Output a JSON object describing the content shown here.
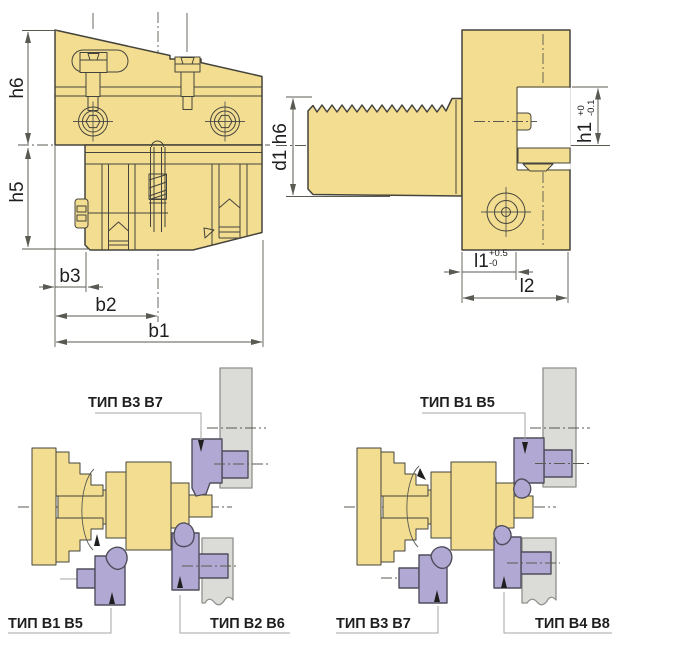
{
  "colors": {
    "background": "#FFFFFF",
    "part_fill": "#F3DD91",
    "part_outline": "#45443C",
    "dim_line": "#5A5A52",
    "text": "#1F1F1F",
    "tool_fill": "#B1A9D3",
    "tool_outline": "#504E5C",
    "turret_fill": "#DBDBD8",
    "turret_outline": "#8F8F8B",
    "leader": "#A5A5A0"
  },
  "front_view": {
    "dim_h6": "h6",
    "dim_h5": "h5",
    "dim_b3": "b3",
    "dim_b2": "b2",
    "dim_b1": "b1"
  },
  "side_view": {
    "dim_d1": "d1 h6",
    "dim_h1": "h1",
    "dim_h1_upper_tol": "+0",
    "dim_h1_lower_tol": "-0.1",
    "dim_l1": "l1",
    "dim_l1_upper_tol": "+0.5",
    "dim_l1_lower_tol": "-0",
    "dim_l2": "l2"
  },
  "setup_left": {
    "top_label": "ТИП B3 B7",
    "bottom_left_label": "ТИП B1 B5",
    "bottom_right_label": "ТИП B2 B6"
  },
  "setup_right": {
    "top_label": "ТИП B1 B5",
    "bottom_left_label": "ТИП B3 B7",
    "bottom_right_label": "ТИП B4 B8"
  }
}
